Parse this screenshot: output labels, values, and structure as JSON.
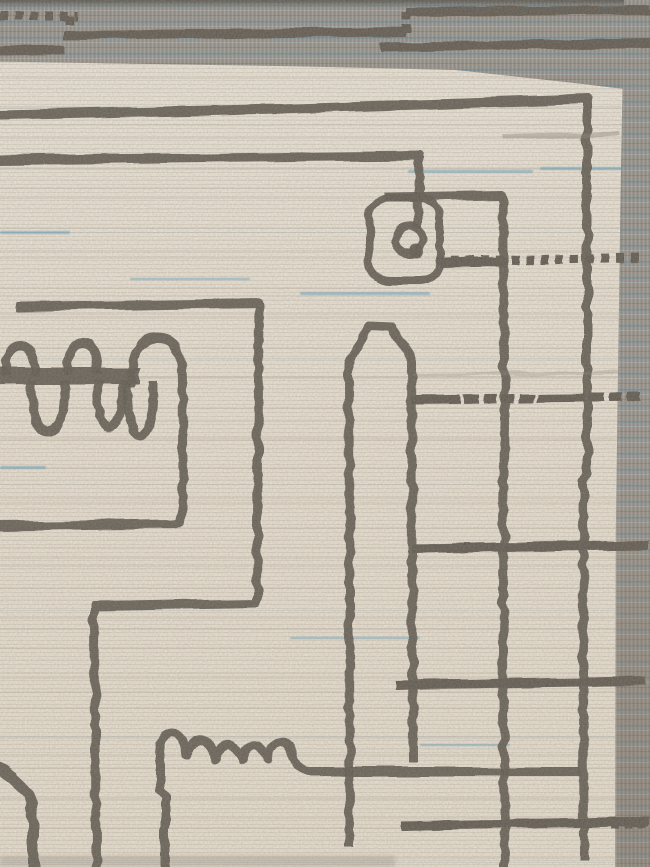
{
  "scene": {
    "subject": "corner detail of a handwoven ivory wool rug",
    "style": "abstract charcoal free-form line drawing on cream pile, grey flatweave kilim border along top and right edges, blue and dark-brown running-stitch accent lines"
  },
  "palette": {
    "field": "#EDE5D7",
    "line": "#5F584F",
    "border_grey": "#95928B",
    "border_dark_edge": "#6E6C66",
    "stitch_blue": "#2B9CD8",
    "stitch_brown": "#32231B",
    "underlay_grey": "#9A948B"
  },
  "borders": {
    "top": {
      "position": "top",
      "texture": "grey flatweave band with horizontal blue weft stripes"
    },
    "right": {
      "position": "right",
      "texture": "grey flatweave band with horizontal blue weft stripes"
    }
  },
  "motifs": [
    {
      "name": "top-frame-line",
      "shape": "long horizontal line across the top turning down into a tall right-hand vertical"
    },
    {
      "name": "second-line-stem",
      "shape": "second horizontal line ending in a stem that drops into a ring"
    },
    {
      "name": "loop-cartouche",
      "shape": "rounded square enclosing a small ring with a knob"
    },
    {
      "name": "third-line-vertical",
      "shape": "short horizontal line turning into a full-height vertical"
    },
    {
      "name": "comb-motif",
      "shape": "thick bar with three domes on top and three fingers hanging below, right dome dropping into an L-hook"
    },
    {
      "name": "hook-line",
      "shape": "large rectangular meander hook descending to the bottom edge"
    },
    {
      "name": "castle-motif",
      "shape": "scallop-topped wall rising from the bottom edge, running right as a long baseline"
    },
    {
      "name": "tower-motif",
      "shape": "tall peaked tower outline in the lower middle"
    },
    {
      "name": "corner-swoop",
      "shape": "small curved line in the bottom-left corner"
    }
  ],
  "stitch_lines": [
    {
      "x1": 0,
      "y1": 16,
      "x2": 78,
      "y2": 16,
      "kind": "brown"
    },
    {
      "x1": 70,
      "y1": 16,
      "x2": 70,
      "y2": 36,
      "kind": "blue"
    },
    {
      "x1": 64,
      "y1": 35,
      "x2": 406,
      "y2": 32,
      "kind": "alt"
    },
    {
      "x1": 406,
      "y1": 33,
      "x2": 406,
      "y2": 12,
      "kind": "blue"
    },
    {
      "x1": 406,
      "y1": 12,
      "x2": 650,
      "y2": 10,
      "kind": "alt"
    },
    {
      "x1": 0,
      "y1": 51,
      "x2": 64,
      "y2": 50,
      "kind": "alt"
    },
    {
      "x1": 380,
      "y1": 47,
      "x2": 650,
      "y2": 43,
      "kind": "brown_gray"
    },
    {
      "x1": 440,
      "y1": 263,
      "x2": 507,
      "y2": 262,
      "kind": "gray"
    },
    {
      "x1": 436,
      "y1": 261,
      "x2": 643,
      "y2": 258,
      "kind": "brown"
    },
    {
      "x1": 411,
      "y1": 400,
      "x2": 641,
      "y2": 397,
      "kind": "alt_blue"
    },
    {
      "x1": 412,
      "y1": 549,
      "x2": 648,
      "y2": 545,
      "kind": "brown_gray"
    },
    {
      "x1": 396,
      "y1": 685,
      "x2": 645,
      "y2": 681,
      "kind": "alt"
    },
    {
      "x1": 401,
      "y1": 826,
      "x2": 649,
      "y2": 821,
      "kind": "brown_gray"
    },
    {
      "x1": 610,
      "y1": 824,
      "x2": 650,
      "y2": 822,
      "kind": "blue"
    }
  ]
}
